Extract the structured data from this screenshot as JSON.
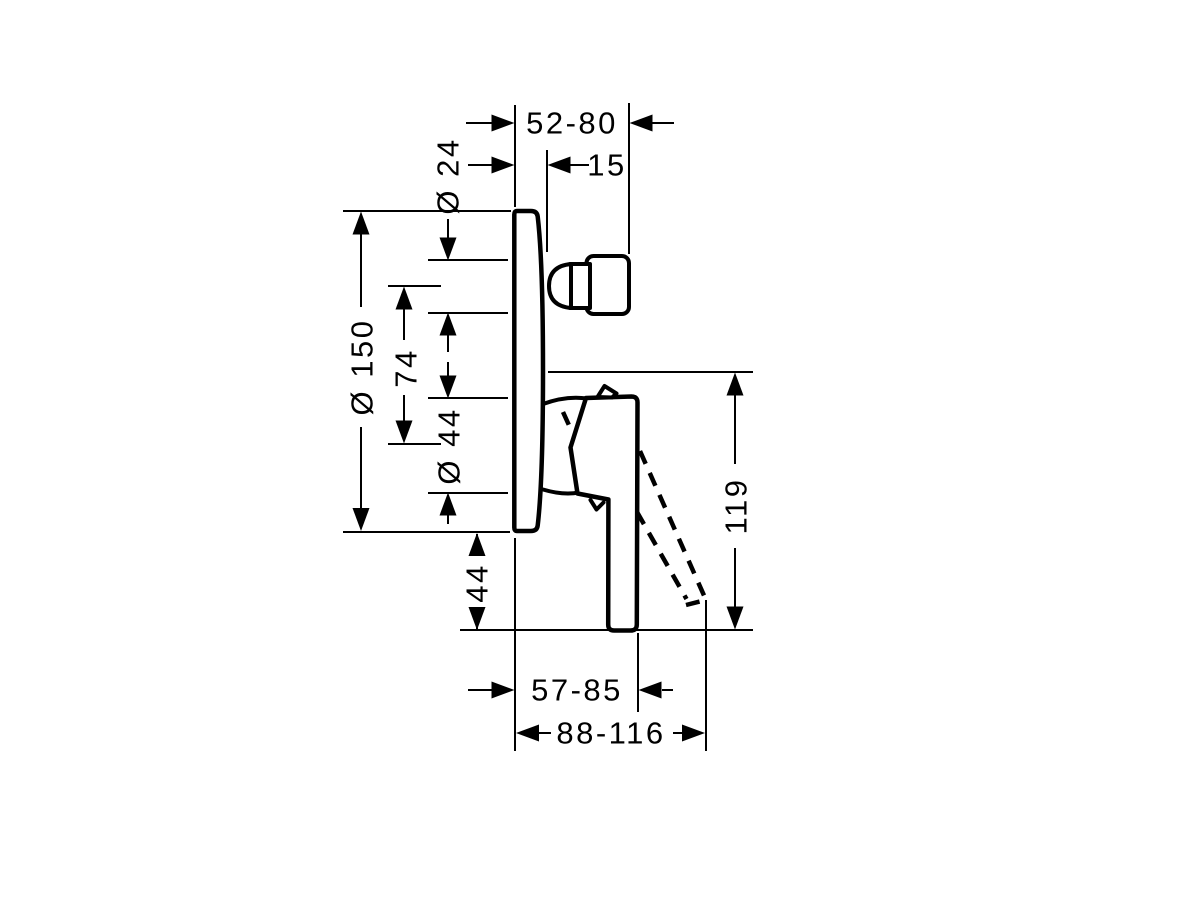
{
  "page": {
    "background_color": "#ffffff",
    "line_color": "#000000"
  },
  "drawing": {
    "kind": "technical-dimension-drawing",
    "subject": "concealed single-lever mixer, side elevation",
    "dimensions": {
      "wall_to_stop_valve": "52-80",
      "wall_to_sleeve": "15",
      "stop_valve_diameter": "Ø 24",
      "escutcheon_diameter": "Ø 150",
      "stop_to_cartridge_centers": "74",
      "sleeve_diameter": "Ø 44",
      "escutcheon_to_lever_end": "44",
      "lever_span": "119",
      "wall_to_lever_grip": "57-85",
      "wall_to_lever_swung": "88-116"
    }
  }
}
